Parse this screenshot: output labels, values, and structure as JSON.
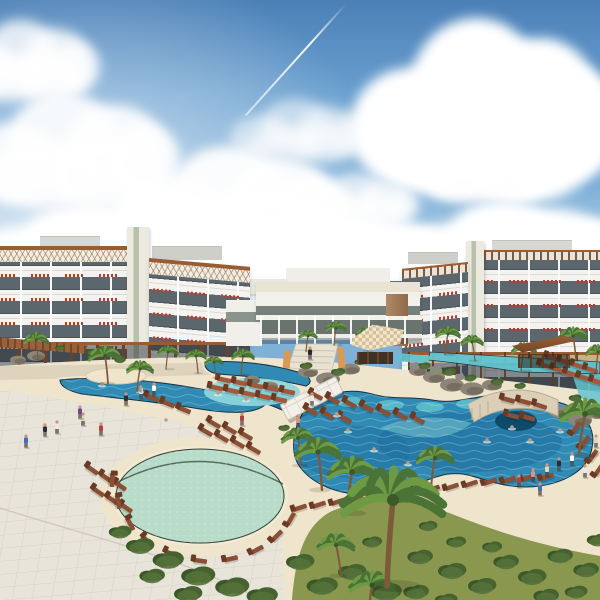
{
  "scene": {
    "description": "Architectural rendering of a tropical resort: two white five-story hotel wings with balconies and red tile accents flank a low lobby building and thatched hut, fronted by free-form swimming pools, a round pale-green kids pool, sandy decks with rows of wooden lounge chairs, palm trees, hedges, lawns and small figures of guests under a blue sky with large cumulus clouds and jet contrails."
  },
  "palette": {
    "sky_top": "#4b80b7",
    "sky_mid": "#7fb0d8",
    "sky_horizon": "#e2ecf4",
    "facade": "#f4f3ef",
    "glass": "#5c666d",
    "accent": "#bf3a28",
    "wood": "#9a5c33",
    "wood_dark": "#6e4124",
    "cream": "#efe5cf",
    "plaza": "#e8e4da",
    "tile": "#c9c4b6",
    "sand": "#efe4cc",
    "pool_deep": "#1d6d9e",
    "pool_mid": "#2f8ab4",
    "pool_light": "#62c4cf",
    "ledge": "#8ed6da",
    "kids": "#b7dcc9",
    "grass": "#8a974f",
    "hedge": "#41602f",
    "palm1": "#4a7335",
    "palm2": "#6f9a44",
    "trunk": "#7d5b3a",
    "chair": "#8a4f35",
    "chair_w": "#a3583a",
    "skin": "#c89878",
    "rock": "#8d8577",
    "sea": "#55655e"
  },
  "sky": {
    "clouds": [
      {
        "x": 350,
        "y": 8,
        "w": 270,
        "h": 200,
        "o": 1
      },
      {
        "x": -50,
        "y": 15,
        "w": 150,
        "h": 90,
        "o": 0.8
      },
      {
        "x": -40,
        "y": 85,
        "w": 220,
        "h": 130,
        "o": 0.9
      },
      {
        "x": 230,
        "y": 95,
        "w": 140,
        "h": 70,
        "o": 0.55
      },
      {
        "x": 120,
        "y": 140,
        "w": 230,
        "h": 120,
        "o": 0.95
      },
      {
        "x": 420,
        "y": 130,
        "w": 130,
        "h": 75,
        "o": 0.85
      },
      {
        "x": 60,
        "y": 185,
        "w": 220,
        "h": 100,
        "o": 1
      },
      {
        "x": 300,
        "y": 170,
        "w": 120,
        "h": 60,
        "o": 0.7
      },
      {
        "x": -30,
        "y": 200,
        "w": 240,
        "h": 90,
        "o": 1
      },
      {
        "x": 180,
        "y": 205,
        "w": 280,
        "h": 85,
        "o": 1
      },
      {
        "x": 400,
        "y": 195,
        "w": 220,
        "h": 95,
        "o": 1
      },
      {
        "x": 540,
        "y": 215,
        "w": 120,
        "h": 80,
        "o": 0.95
      }
    ],
    "contrails": [
      {
        "x": 345,
        "y": 4,
        "len": 150,
        "rot": 42
      },
      {
        "x": 527,
        "y": 98,
        "len": 115,
        "rot": 31
      }
    ]
  },
  "people_colors": [
    "#3f6fb5",
    "#2c2c34",
    "#e9e9e9",
    "#b34040",
    "#e3d7c3",
    "#6a4a8a",
    "#ffffff",
    "#d89090",
    "#444c58",
    "#c8b890"
  ],
  "ground": {
    "chairs": [
      [
        316,
        396,
        28,
        0
      ],
      [
        333,
        400,
        28,
        0
      ],
      [
        350,
        404,
        28,
        0
      ],
      [
        367,
        408,
        28,
        0
      ],
      [
        384,
        412,
        28,
        0
      ],
      [
        401,
        416,
        28,
        0
      ],
      [
        418,
        420,
        28,
        0
      ],
      [
        311,
        411,
        28,
        0
      ],
      [
        328,
        415,
        28,
        0
      ],
      [
        345,
        419,
        28,
        0
      ],
      [
        508,
        400,
        15,
        0
      ],
      [
        524,
        402,
        15,
        0
      ],
      [
        540,
        406,
        18,
        0
      ],
      [
        512,
        416,
        15,
        0
      ],
      [
        528,
        418,
        15,
        0
      ],
      [
        576,
        428,
        -55,
        0
      ],
      [
        585,
        442,
        -55,
        0
      ],
      [
        593,
        456,
        -55,
        0
      ],
      [
        599,
        470,
        -55,
        0
      ],
      [
        545,
        366,
        18,
        1
      ],
      [
        558,
        370,
        18,
        1
      ],
      [
        571,
        374,
        18,
        1
      ],
      [
        584,
        378,
        18,
        1
      ],
      [
        597,
        382,
        18,
        1
      ],
      [
        552,
        358,
        18,
        1
      ],
      [
        565,
        362,
        18,
        1
      ],
      [
        578,
        366,
        18,
        1
      ],
      [
        591,
        370,
        18,
        1
      ],
      [
        300,
        508,
        -18,
        0
      ],
      [
        319,
        505,
        -18,
        0
      ],
      [
        338,
        502,
        -18,
        0
      ],
      [
        357,
        500,
        -18,
        0
      ],
      [
        376,
        497,
        -18,
        0
      ],
      [
        395,
        494,
        -18,
        0
      ],
      [
        414,
        491,
        -18,
        0
      ],
      [
        433,
        489,
        -18,
        0
      ],
      [
        452,
        487,
        -18,
        0
      ],
      [
        471,
        484,
        -18,
        0
      ],
      [
        490,
        482,
        -18,
        0
      ],
      [
        509,
        480,
        -18,
        0
      ],
      [
        528,
        478,
        -18,
        0
      ],
      [
        547,
        477,
        -18,
        0
      ],
      [
        216,
        388,
        12,
        1
      ],
      [
        232,
        391,
        12,
        1
      ],
      [
        248,
        394,
        12,
        1
      ],
      [
        264,
        397,
        12,
        1
      ],
      [
        280,
        400,
        12,
        1
      ],
      [
        224,
        380,
        12,
        1
      ],
      [
        240,
        383,
        12,
        1
      ],
      [
        256,
        386,
        12,
        1
      ],
      [
        272,
        389,
        12,
        1
      ],
      [
        288,
        392,
        12,
        1
      ],
      [
        206,
        432,
        30,
        0
      ],
      [
        222,
        438,
        30,
        0
      ],
      [
        238,
        444,
        30,
        0
      ],
      [
        254,
        450,
        30,
        0
      ],
      [
        214,
        424,
        30,
        0
      ],
      [
        230,
        430,
        30,
        0
      ],
      [
        246,
        436,
        30,
        0
      ],
      [
        92,
        470,
        35,
        0
      ],
      [
        106,
        478,
        35,
        0
      ],
      [
        120,
        486,
        35,
        0
      ],
      [
        98,
        492,
        35,
        0
      ],
      [
        112,
        500,
        35,
        0
      ],
      [
        126,
        508,
        35,
        0
      ],
      [
        118,
        502,
        80,
        0
      ],
      [
        130,
        524,
        62,
        0
      ],
      [
        147,
        541,
        45,
        0
      ],
      [
        171,
        554,
        25,
        0
      ],
      [
        200,
        561,
        8,
        0
      ],
      [
        231,
        559,
        -12,
        0
      ],
      [
        257,
        550,
        -28,
        0
      ],
      [
        277,
        536,
        -45,
        0
      ],
      [
        291,
        519,
        -60,
        0
      ],
      [
        112,
        480,
        92,
        0
      ],
      [
        152,
        398,
        22,
        0
      ],
      [
        168,
        404,
        22,
        0
      ],
      [
        184,
        410,
        22,
        0
      ]
    ],
    "palms": [
      [
        105,
        356,
        16,
        -3
      ],
      [
        140,
        369,
        13,
        3
      ],
      [
        36,
        340,
        12,
        -2
      ],
      [
        243,
        356,
        11,
        2
      ],
      [
        214,
        362,
        9,
        -2
      ],
      [
        336,
        328,
        10,
        2
      ],
      [
        366,
        334,
        10,
        -2
      ],
      [
        308,
        336,
        9,
        2
      ],
      [
        448,
        334,
        12,
        3
      ],
      [
        472,
        342,
        11,
        -3
      ],
      [
        524,
        350,
        12,
        3
      ],
      [
        573,
        336,
        14,
        -3
      ],
      [
        598,
        352,
        12,
        2
      ],
      [
        168,
        352,
        10,
        2
      ],
      [
        196,
        356,
        10,
        -2
      ],
      [
        298,
        438,
        16,
        -3
      ],
      [
        318,
        452,
        22,
        -4
      ],
      [
        435,
        458,
        18,
        4
      ],
      [
        585,
        414,
        24,
        6
      ],
      [
        336,
        545,
        18,
        -5
      ],
      [
        372,
        585,
        22,
        4
      ],
      [
        352,
        472,
        24,
        5
      ],
      [
        393,
        500,
        50,
        6
      ]
    ],
    "people": [
      [
        26,
        441,
        0
      ],
      [
        45,
        430,
        1
      ],
      [
        57,
        427,
        2
      ],
      [
        83,
        419,
        4
      ],
      [
        101,
        429,
        3
      ],
      [
        126,
        399,
        1
      ],
      [
        141,
        392,
        2
      ],
      [
        154,
        389,
        6
      ],
      [
        242,
        419,
        3
      ],
      [
        80,
        412,
        5
      ],
      [
        298,
        421,
        7
      ],
      [
        312,
        399,
        2
      ],
      [
        310,
        353,
        1
      ],
      [
        519,
        481,
        3
      ],
      [
        533,
        475,
        7
      ],
      [
        547,
        470,
        4
      ],
      [
        559,
        464,
        1
      ],
      [
        572,
        459,
        6
      ],
      [
        585,
        471,
        2
      ],
      [
        540,
        489,
        0
      ],
      [
        596,
        441,
        4
      ]
    ],
    "swimmers": [
      [
        348,
        430
      ],
      [
        374,
        449
      ],
      [
        408,
        463
      ],
      [
        446,
        453
      ],
      [
        487,
        440
      ],
      [
        512,
        427
      ],
      [
        337,
        414
      ],
      [
        246,
        399
      ],
      [
        218,
        393
      ],
      [
        166,
        420
      ],
      [
        102,
        384
      ],
      [
        140,
        390
      ],
      [
        530,
        440
      ],
      [
        560,
        430
      ]
    ],
    "bushes": [
      [
        140,
        546,
        20
      ],
      [
        168,
        560,
        22
      ],
      [
        198,
        576,
        24
      ],
      [
        232,
        587,
        24
      ],
      [
        262,
        596,
        22
      ],
      [
        152,
        576,
        18
      ],
      [
        188,
        594,
        20
      ],
      [
        120,
        532,
        16
      ],
      [
        300,
        562,
        20
      ],
      [
        322,
        586,
        22
      ],
      [
        352,
        572,
        20
      ],
      [
        386,
        592,
        22
      ],
      [
        420,
        557,
        18
      ],
      [
        452,
        571,
        20
      ],
      [
        482,
        586,
        20
      ],
      [
        506,
        562,
        18
      ],
      [
        532,
        577,
        20
      ],
      [
        560,
        556,
        18
      ],
      [
        586,
        570,
        18
      ],
      [
        598,
        540,
        16
      ],
      [
        456,
        542,
        14
      ],
      [
        428,
        526,
        13
      ],
      [
        372,
        542,
        14
      ],
      [
        338,
        541,
        13
      ],
      [
        492,
        547,
        14
      ],
      [
        546,
        596,
        18
      ],
      [
        576,
        592,
        16
      ],
      [
        416,
        592,
        18
      ],
      [
        446,
        600,
        16
      ]
    ],
    "shrubs": [
      [
        306,
        366,
        9
      ],
      [
        338,
        372,
        10
      ],
      [
        424,
        366,
        9
      ],
      [
        449,
        372,
        10
      ],
      [
        470,
        378,
        9
      ],
      [
        497,
        382,
        9
      ],
      [
        520,
        386,
        8
      ],
      [
        284,
        428,
        8
      ],
      [
        302,
        432,
        8
      ],
      [
        92,
        352,
        8
      ],
      [
        120,
        360,
        8
      ],
      [
        60,
        348,
        7
      ],
      [
        575,
        398,
        9
      ],
      [
        595,
        408,
        8
      ],
      [
        360,
        362,
        8
      ]
    ],
    "flowers": [
      [
        436,
        370,
        10
      ],
      [
        414,
        366,
        8
      ],
      [
        460,
        377,
        8
      ]
    ],
    "rocks": [
      [
        308,
        372,
        10
      ],
      [
        328,
        379,
        12
      ],
      [
        350,
        369,
        10
      ],
      [
        418,
        371,
        9
      ],
      [
        434,
        377,
        11
      ],
      [
        452,
        385,
        12
      ],
      [
        472,
        389,
        12
      ],
      [
        492,
        385,
        10
      ],
      [
        560,
        412,
        11
      ],
      [
        580,
        420,
        12
      ],
      [
        597,
        414,
        9
      ],
      [
        252,
        380,
        8
      ],
      [
        270,
        386,
        8
      ],
      [
        36,
        356,
        9
      ],
      [
        18,
        360,
        8
      ]
    ]
  }
}
